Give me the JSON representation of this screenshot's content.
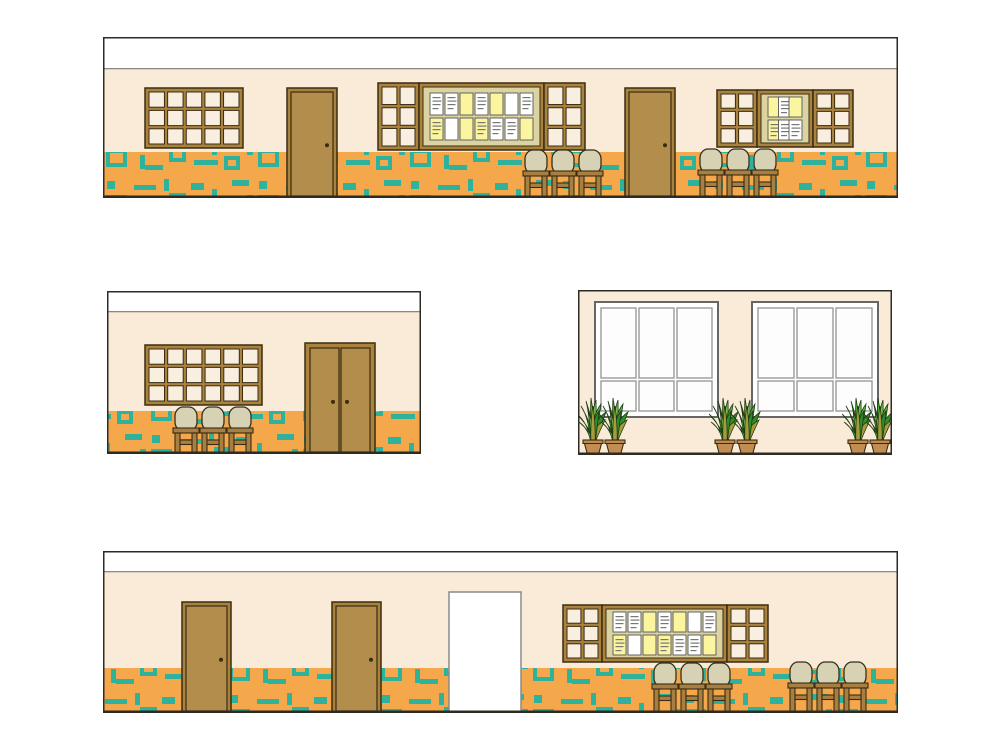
{
  "document": {
    "type": "interior-elevation-drawing",
    "background": "#ffffff"
  },
  "colors": {
    "panel_outline": "#2e2a24",
    "band_fill": "#ffffff",
    "band_line": "#8a8a8a",
    "wall": "#f9ebd8",
    "wainscot": "#f5a74c",
    "accent_teal": "#2fb29b",
    "wood_frame": "#a9823e",
    "wood_door": "#b28d4c",
    "wood_dark": "#3a2c12",
    "pane": "#f9efe0",
    "board_field": "#dbd3a2",
    "paper_white": "#ffffff",
    "paper_yellow": "#fbf5a0",
    "paper_line": "#777777",
    "chair_seat": "#d8d2b4",
    "chair_wood": "#a87f42",
    "big_window_frame": "#ffffff",
    "big_window_outline": "#666666",
    "big_window_pane": "#fdfdfd",
    "big_window_mullion": "#9a9a9a",
    "plant_greens": [
      "#2f8d2b",
      "#56b13c",
      "#a89b3b",
      "#74c24f"
    ],
    "plant_outline": "#1e3d13",
    "pot": "#c28d52",
    "opening_fill": "#ffffff",
    "opening_outline": "#8a8a8a"
  },
  "panels": [
    {
      "name": "elevation-top",
      "x": 103,
      "y": 37,
      "w": 795,
      "h": 161,
      "band_h": 32,
      "wainscot_y": 115,
      "elements": [
        {
          "type": "window",
          "name": "window-grid",
          "x": 42,
          "y": 51,
          "w": 98,
          "h": 60,
          "cols": 5,
          "rows": 3
        },
        {
          "type": "door",
          "name": "door",
          "x": 184,
          "y": 51,
          "w": 50,
          "h": 110
        },
        {
          "type": "window",
          "name": "window-grid",
          "x": 275,
          "y": 46,
          "w": 41,
          "h": 67,
          "cols": 2,
          "rows": 3
        },
        {
          "type": "board",
          "name": "notice-board",
          "x": 316,
          "y": 46,
          "w": 125,
          "h": 67,
          "papers": [
            [
              "wt",
              "wt",
              "y",
              "wt",
              "y",
              "w",
              "wt"
            ],
            [
              "yt",
              "w",
              "y",
              "yt",
              "wt",
              "wt",
              "y"
            ]
          ]
        },
        {
          "type": "window",
          "name": "window-grid",
          "x": 441,
          "y": 46,
          "w": 41,
          "h": 67,
          "cols": 2,
          "rows": 3
        },
        {
          "type": "door",
          "name": "door",
          "x": 522,
          "y": 51,
          "w": 50,
          "h": 110
        },
        {
          "type": "window",
          "name": "window-grid",
          "x": 614,
          "y": 53,
          "w": 40,
          "h": 57,
          "cols": 2,
          "rows": 3
        },
        {
          "type": "board",
          "name": "notice-board",
          "x": 654,
          "y": 53,
          "w": 56,
          "h": 57,
          "papers": [
            [
              "y",
              "wt",
              "y"
            ],
            [
              "yt",
              "wt",
              "wt"
            ]
          ]
        },
        {
          "type": "window",
          "name": "window-grid",
          "x": 710,
          "y": 53,
          "w": 40,
          "h": 57,
          "cols": 2,
          "rows": 3
        },
        {
          "type": "chairs",
          "name": "chair-row",
          "x": 420,
          "y": 113,
          "count": 3
        },
        {
          "type": "chairs",
          "name": "chair-row",
          "x": 595,
          "y": 112,
          "count": 3
        }
      ]
    },
    {
      "name": "elevation-mid-left",
      "x": 107,
      "y": 291,
      "w": 314,
      "h": 163,
      "band_h": 21,
      "wainscot_y": 120,
      "elements": [
        {
          "type": "window",
          "name": "window-grid",
          "x": 38,
          "y": 54,
          "w": 117,
          "h": 60,
          "cols": 6,
          "rows": 3
        },
        {
          "type": "double-door",
          "name": "double-door",
          "x": 198,
          "y": 52,
          "w": 70,
          "h": 111
        },
        {
          "type": "chairs",
          "name": "chair-row",
          "x": 66,
          "y": 116,
          "count": 3
        }
      ]
    },
    {
      "name": "elevation-mid-right",
      "x": 578,
      "y": 290,
      "w": 314,
      "h": 165,
      "band_h": 0,
      "wainscot_y": null,
      "elements": [
        {
          "type": "big-window",
          "name": "large-window",
          "x": 17,
          "y": 12,
          "w": 123,
          "h": 115
        },
        {
          "type": "big-window",
          "name": "large-window",
          "x": 174,
          "y": 12,
          "w": 126,
          "h": 115
        },
        {
          "type": "plants",
          "name": "potted-plants",
          "x": 5,
          "bottom": 163,
          "pots": 2
        },
        {
          "type": "plants",
          "name": "potted-plants",
          "x": 137,
          "bottom": 163,
          "pots": 2
        },
        {
          "type": "plants",
          "name": "potted-plants",
          "x": 270,
          "bottom": 163,
          "pots": 2
        }
      ]
    },
    {
      "name": "elevation-bottom",
      "x": 103,
      "y": 551,
      "w": 795,
      "h": 162,
      "band_h": 21,
      "wainscot_y": 117,
      "elements": [
        {
          "type": "door",
          "name": "door",
          "x": 79,
          "y": 51,
          "w": 49,
          "h": 111
        },
        {
          "type": "door",
          "name": "door",
          "x": 229,
          "y": 51,
          "w": 49,
          "h": 111
        },
        {
          "type": "opening",
          "name": "doorway-opening",
          "x": 346,
          "y": 41,
          "w": 72,
          "h": 121
        },
        {
          "type": "window",
          "name": "window-grid",
          "x": 460,
          "y": 54,
          "w": 39,
          "h": 57,
          "cols": 2,
          "rows": 3
        },
        {
          "type": "board",
          "name": "notice-board",
          "x": 499,
          "y": 54,
          "w": 125,
          "h": 57,
          "papers": [
            [
              "wt",
              "wt",
              "y",
              "wt",
              "y",
              "w",
              "wt"
            ],
            [
              "yt",
              "w",
              "y",
              "yt",
              "wt",
              "wt",
              "y"
            ]
          ]
        },
        {
          "type": "window",
          "name": "window-grid",
          "x": 624,
          "y": 54,
          "w": 41,
          "h": 57,
          "cols": 2,
          "rows": 3
        },
        {
          "type": "chairs",
          "name": "chair-row",
          "x": 549,
          "y": 112,
          "count": 3
        },
        {
          "type": "chairs",
          "name": "chair-row",
          "x": 685,
          "y": 111,
          "count": 3
        }
      ]
    }
  ],
  "wainscot_pattern": {
    "tile_w": 152,
    "tile_h": 46,
    "shapes": [
      {
        "kind": "fill",
        "x": 4,
        "y": 6,
        "w": 8,
        "h": 8
      },
      {
        "kind": "hollow",
        "x": 3,
        "y": 20,
        "w": 21,
        "h": 18
      },
      {
        "kind": "fill",
        "x": 31,
        "y": 10,
        "w": 22,
        "h": 5
      },
      {
        "kind": "fill",
        "x": 37,
        "y": 26,
        "w": 5,
        "h": 14
      },
      {
        "kind": "fill",
        "x": 42,
        "y": 36,
        "w": 18,
        "h": 5
      },
      {
        "kind": "fill",
        "x": 61,
        "y": 4,
        "w": 5,
        "h": 12
      },
      {
        "kind": "hollow",
        "x": 66,
        "y": 18,
        "w": 17,
        "h": 15
      },
      {
        "kind": "fill",
        "x": 88,
        "y": 8,
        "w": 13,
        "h": 7
      },
      {
        "kind": "fill",
        "x": 91,
        "y": 31,
        "w": 24,
        "h": 5
      },
      {
        "kind": "fill",
        "x": 109,
        "y": 14,
        "w": 5,
        "h": 12
      },
      {
        "kind": "hollow",
        "x": 121,
        "y": 27,
        "w": 16,
        "h": 14
      },
      {
        "kind": "fill",
        "x": 129,
        "y": 5,
        "w": 17,
        "h": 6
      },
      {
        "kind": "fill",
        "x": 144,
        "y": 20,
        "w": 6,
        "h": 6
      }
    ]
  }
}
